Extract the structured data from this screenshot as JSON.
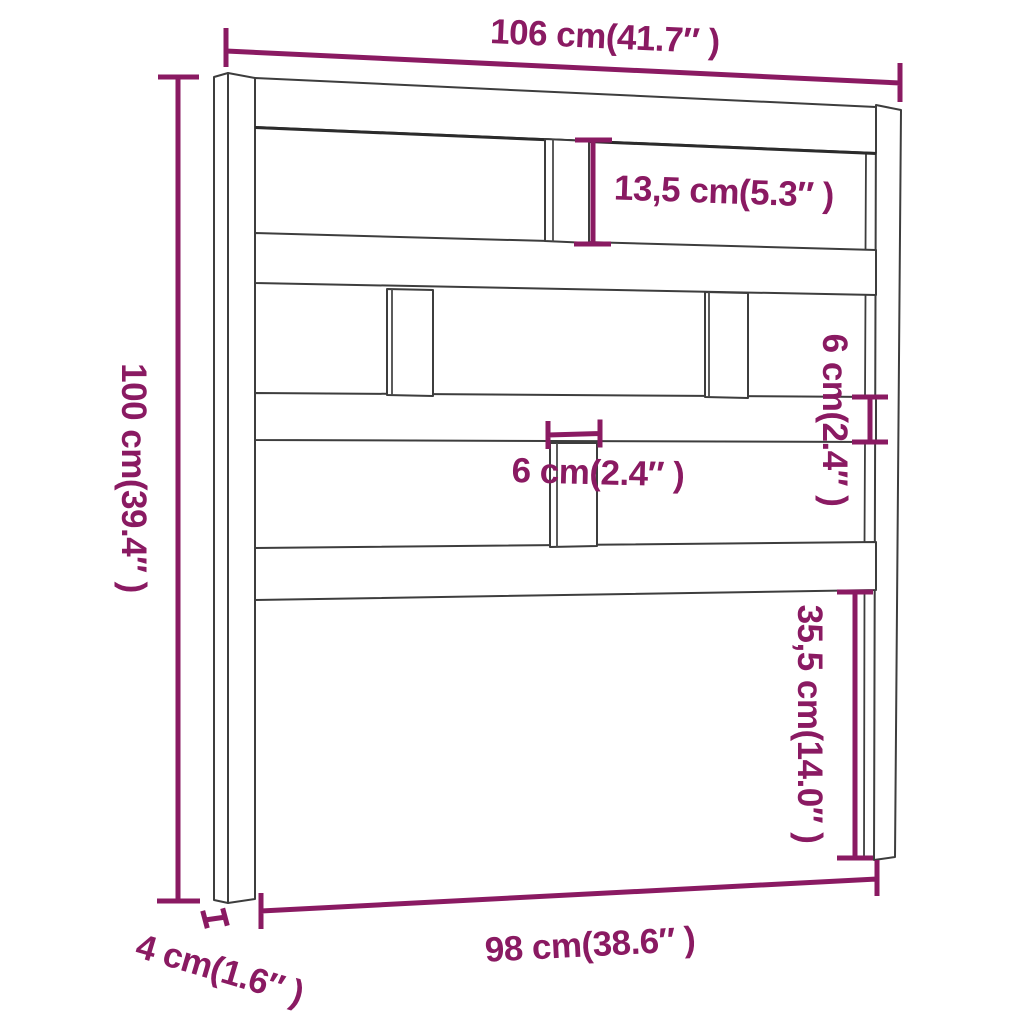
{
  "title": "Headboard dimension diagram",
  "colors": {
    "dimension": "#8A1A62",
    "outline": "#3D3D3D",
    "outline_accent": "#2B2B2B",
    "slat_edge": "#4A4A4A",
    "background": "#FFFFFF"
  },
  "dimensions": {
    "overall_width": {
      "label": "106 cm(41.7″ )"
    },
    "overall_height": {
      "label": "100 cm(39.4″ )"
    },
    "top_opening_height": {
      "label": "13,5 cm(5.3″ )"
    },
    "rail_height": {
      "label": "6 cm(2.4″ )"
    },
    "slat_width": {
      "label": "6 cm(2.4″ )"
    },
    "bottom_opening_height": {
      "label": "35,5 cm(14.0″ )"
    },
    "inner_width": {
      "label": "98 cm(38.6″ )"
    },
    "leg_width": {
      "label": "4 cm(1.6″ )"
    }
  }
}
